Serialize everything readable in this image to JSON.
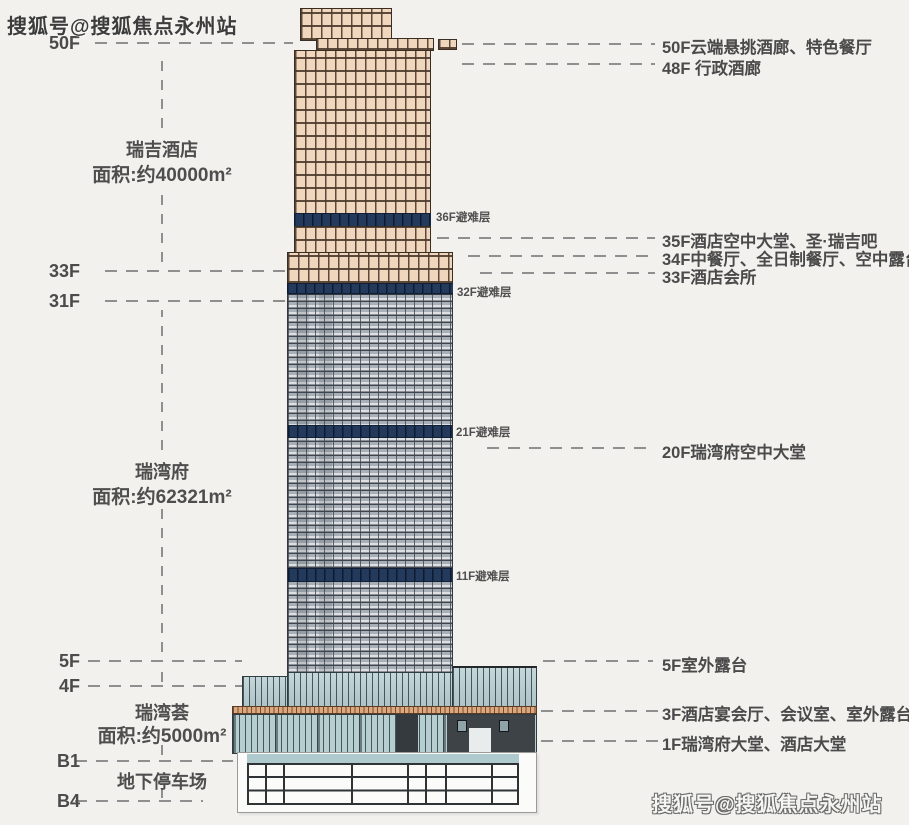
{
  "watermark": {
    "top_left": "搜狐号@搜狐焦点永州站",
    "bottom_right": "搜狐号@搜狐焦点永州站"
  },
  "left_column": {
    "floor_marks": [
      "50F",
      "33F",
      "31F",
      "5F",
      "4F",
      "B1",
      "B4"
    ],
    "sections": [
      {
        "name": "瑞吉酒店",
        "area": "面积:约40000m²"
      },
      {
        "name": "瑞湾府",
        "area": "面积:约62321m²"
      },
      {
        "name": "瑞湾荟",
        "area": "面积:约5000m²"
      }
    ],
    "basement_label": "地下停车场"
  },
  "right_column": {
    "annotations": [
      "50F云端悬挑酒廊、特色餐厅",
      "48F 行政酒廊",
      "35F酒店空中大堂、圣·瑞吉吧",
      "34F中餐厅、全日制餐厅、空中露台",
      "33F酒店会所",
      "20F瑞湾府空中大堂",
      "5F室外露台",
      "3F酒店宴会厅、会议室、室外露台",
      "1F瑞湾府大堂、酒店大堂"
    ]
  },
  "building": {
    "refuge_labels": [
      "36F避难层",
      "32F避难层",
      "21F避难层",
      "11F避难层"
    ],
    "colors": {
      "background": "#f2f1ee",
      "hotel_facade": "#efd6bc",
      "refuge_band": "#233a5c",
      "residence_facade": "#dcdfe1",
      "podium_glass": "#b7ced1",
      "podium_band": "#dda87d",
      "podium_dark": "#3e4347",
      "basement": "#fbfbfa"
    }
  }
}
